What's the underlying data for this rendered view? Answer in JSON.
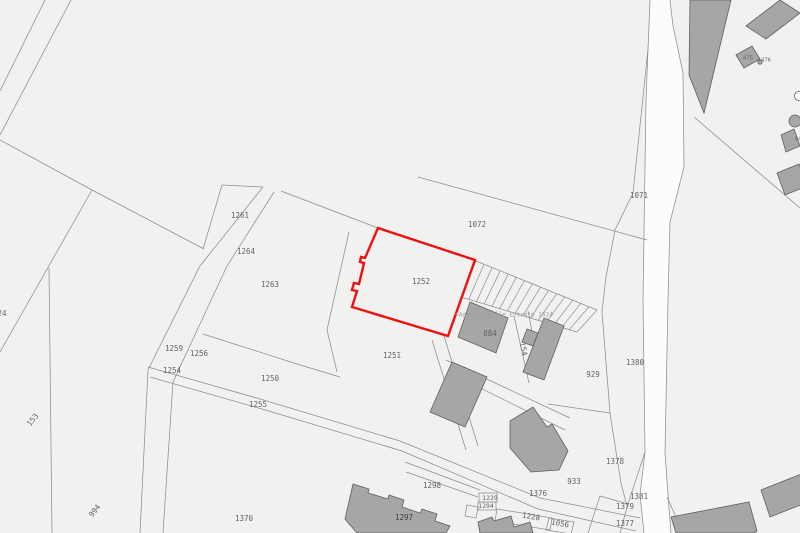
{
  "map": {
    "colors": {
      "background": "#f1f1ef",
      "parcel_line": "#8d8d8d",
      "building_fill": "#a6a6a6",
      "building_stroke": "#5f5f5f",
      "road_fill": "#fcfcfb",
      "highlight_red": "#ee1010",
      "label_gray": "#636363",
      "label_dark": "#3f3f3f",
      "watermark_gray": "#9c9c9c"
    },
    "watermark": {
      "text": "©Agenzia delle Entrate 2024",
      "x": 504,
      "y": 315,
      "size": 6
    },
    "highlighted_parcel": {
      "number": "1252",
      "path": "M378,228 L475,260 L448,336 L352,307 L357,291 L352,290 L354,283 L359,284 L364,263 L360,262 L361,257 L365,258 Z",
      "stroke_width": 2.4
    },
    "labels": [
      {
        "text": "1261",
        "x": 240,
        "y": 216
      },
      {
        "text": "1264",
        "x": 246,
        "y": 252
      },
      {
        "text": "1263",
        "x": 270,
        "y": 285
      },
      {
        "text": "1259",
        "x": 174,
        "y": 349
      },
      {
        "text": "1256",
        "x": 199,
        "y": 354
      },
      {
        "text": "1254",
        "x": 172,
        "y": 371
      },
      {
        "text": "1250",
        "x": 270,
        "y": 379
      },
      {
        "text": "1255",
        "x": 258,
        "y": 405
      },
      {
        "text": "153",
        "x": 33,
        "y": 420,
        "rot": -52
      },
      {
        "text": "994",
        "x": 95,
        "y": 511,
        "rot": -52
      },
      {
        "text": "24",
        "x": 2,
        "y": 314
      },
      {
        "text": "1370",
        "x": 244,
        "y": 519
      },
      {
        "text": "1072",
        "x": 477,
        "y": 225
      },
      {
        "text": "1071",
        "x": 639,
        "y": 196
      },
      {
        "text": "1252",
        "x": 421,
        "y": 282
      },
      {
        "text": "1251",
        "x": 392,
        "y": 356
      },
      {
        "text": "884",
        "x": 490,
        "y": 334
      },
      {
        "text": "154",
        "x": 523,
        "y": 349,
        "rot": 78
      },
      {
        "text": "929",
        "x": 593,
        "y": 375
      },
      {
        "text": "1380",
        "x": 635,
        "y": 363
      },
      {
        "text": "1378",
        "x": 615,
        "y": 462
      },
      {
        "text": "933",
        "x": 574,
        "y": 482
      },
      {
        "text": "1376",
        "x": 538,
        "y": 494
      },
      {
        "text": "1298",
        "x": 432,
        "y": 486
      },
      {
        "text": "1297",
        "x": 404,
        "y": 518,
        "dark": true
      },
      {
        "text": "1229",
        "x": 490,
        "y": 498,
        "size": 6.5
      },
      {
        "text": "1294",
        "x": 486,
        "y": 506,
        "size": 6.5
      },
      {
        "text": "1228",
        "x": 531,
        "y": 517,
        "rot": 10
      },
      {
        "text": "1056",
        "x": 560,
        "y": 524,
        "rot": 10
      },
      {
        "text": "1381",
        "x": 639,
        "y": 497
      },
      {
        "text": "1379",
        "x": 625,
        "y": 507
      },
      {
        "text": "1377",
        "x": 625,
        "y": 524
      },
      {
        "text": "475",
        "x": 748,
        "y": 58,
        "size": 5.5
      },
      {
        "text": "476",
        "x": 766,
        "y": 60,
        "size": 5.5
      },
      {
        "text": "94",
        "x": 798,
        "y": 139,
        "size": 5.5
      }
    ],
    "road_fill_polygon": [
      [
        650,
        0
      ],
      [
        646,
        100
      ],
      [
        643,
        300
      ],
      [
        645,
        452
      ],
      [
        640,
        495
      ],
      [
        644,
        533
      ],
      [
        671,
        533
      ],
      [
        668,
        495
      ],
      [
        665,
        452
      ],
      [
        668,
        300
      ],
      [
        670,
        222
      ],
      [
        684,
        167
      ],
      [
        683,
        73
      ],
      [
        673,
        26
      ],
      [
        670,
        0
      ]
    ],
    "boundary_lines": [
      [
        [
          45,
          0
        ],
        [
          0,
          91
        ]
      ],
      [
        [
          71,
          0
        ],
        [
          0,
          135
        ]
      ],
      [
        [
          0,
          140
        ],
        [
          92,
          190
        ]
      ],
      [
        [
          92,
          190
        ],
        [
          204,
          249
        ]
      ],
      [
        [
          92,
          190
        ],
        [
          0,
          352
        ]
      ],
      [
        [
          49,
          268
        ],
        [
          52,
          533
        ]
      ],
      [
        [
          263,
          187
        ],
        [
          200,
          266
        ],
        [
          148,
          370
        ],
        [
          140,
          533
        ]
      ],
      [
        [
          274,
          192
        ],
        [
          227,
          266
        ],
        [
          173,
          382
        ],
        [
          163,
          533
        ]
      ],
      [
        [
          222,
          185
        ],
        [
          203,
          249
        ]
      ],
      [
        [
          222,
          185
        ],
        [
          263,
          187
        ]
      ],
      [
        [
          281,
          191
        ],
        [
          378,
          228
        ]
      ],
      [
        [
          203,
          334
        ],
        [
          297,
          364
        ],
        [
          340,
          377
        ]
      ],
      [
        [
          418,
          177
        ],
        [
          647,
          240
        ]
      ],
      [
        [
          648,
          49
        ],
        [
          633,
          193
        ],
        [
          615,
          230
        ],
        [
          606,
          277
        ],
        [
          602,
          312
        ]
      ],
      [
        [
          602,
          312
        ],
        [
          610,
          413
        ],
        [
          621,
          483
        ],
        [
          627,
          506
        ]
      ],
      [
        [
          476,
          261
        ],
        [
          597,
          310
        ]
      ],
      [
        [
          461,
          297
        ],
        [
          577,
          332
        ]
      ],
      [
        [
          514,
          316
        ],
        [
          529,
          383
        ]
      ],
      [
        [
          528,
          311
        ],
        [
          541,
          378
        ]
      ],
      [
        [
          432,
          340
        ],
        [
          466,
          450
        ]
      ],
      [
        [
          444,
          336
        ],
        [
          478,
          446
        ]
      ],
      [
        [
          446,
          360
        ],
        [
          570,
          418
        ]
      ],
      [
        [
          448,
          372
        ],
        [
          565,
          430
        ]
      ],
      [
        [
          548,
          404
        ],
        [
          610,
          413
        ]
      ],
      [
        [
          148,
          367
        ],
        [
          260,
          399
        ],
        [
          400,
          441
        ],
        [
          540,
          498
        ],
        [
          640,
          518
        ]
      ],
      [
        [
          150,
          377
        ],
        [
          262,
          409
        ],
        [
          402,
          451
        ],
        [
          538,
          509
        ],
        [
          636,
          531
        ]
      ],
      [
        [
          405,
          462
        ],
        [
          480,
          490
        ]
      ],
      [
        [
          406,
          472
        ],
        [
          478,
          497
        ]
      ],
      [
        [
          645,
          452
        ],
        [
          628,
          504
        ],
        [
          620,
          533
        ]
      ],
      [
        [
          628,
          504
        ],
        [
          600,
          496
        ],
        [
          588,
          533
        ]
      ],
      [
        [
          694,
          117
        ],
        [
          800,
          208
        ]
      ],
      [
        [
          667,
          497
        ],
        [
          683,
          533
        ]
      ],
      [
        [
          349,
          232
        ],
        [
          327,
          330
        ],
        [
          337,
          372
        ]
      ],
      [
        [
          650,
          0
        ],
        [
          646,
          100
        ],
        [
          643,
          300
        ],
        [
          645,
          452
        ],
        [
          640,
          495
        ],
        [
          644,
          533
        ]
      ],
      [
        [
          670,
          0
        ],
        [
          673,
          26
        ],
        [
          683,
          73
        ],
        [
          684,
          167
        ],
        [
          670,
          222
        ],
        [
          668,
          300
        ],
        [
          665,
          452
        ],
        [
          668,
          495
        ],
        [
          671,
          533
        ]
      ]
    ],
    "strip_comb": {
      "rail_top": [
        [
          476,
          261
        ],
        [
          597,
          310
        ]
      ],
      "rail_bottom": [
        [
          461,
          297
        ],
        [
          577,
          332
        ]
      ],
      "count": 16
    },
    "small_parcel_outlines": [
      [
        [
          479,
          493
        ],
        [
          497,
          493
        ],
        [
          497,
          502
        ],
        [
          479,
          502
        ]
      ],
      [
        [
          478,
          502
        ],
        [
          496,
          502
        ],
        [
          496,
          510
        ],
        [
          478,
          510
        ]
      ],
      [
        [
          497,
          509
        ],
        [
          552,
          518
        ],
        [
          550,
          530
        ],
        [
          495,
          521
        ]
      ],
      [
        [
          549,
          518
        ],
        [
          574,
          522
        ],
        [
          571,
          534
        ],
        [
          546,
          530
        ]
      ],
      [
        [
          467,
          505
        ],
        [
          478,
          507
        ],
        [
          476,
          518
        ],
        [
          465,
          516
        ]
      ]
    ],
    "buildings": [
      [
        [
          690,
          0
        ],
        [
          731,
          0
        ],
        [
          704,
          113
        ],
        [
          689,
          75
        ]
      ],
      [
        [
          746,
          26
        ],
        [
          780,
          0
        ],
        [
          800,
          13
        ],
        [
          766,
          39
        ]
      ],
      [
        [
          736,
          55
        ],
        [
          752,
          46
        ],
        [
          760,
          59
        ],
        [
          744,
          68
        ]
      ],
      [
        [
          781,
          135
        ],
        [
          794,
          129
        ],
        [
          800,
          146
        ],
        [
          786,
          152
        ]
      ],
      [
        [
          777,
          173
        ],
        [
          799,
          164
        ],
        [
          807,
          186
        ],
        [
          785,
          195
        ]
      ],
      [
        [
          470,
          302
        ],
        [
          508,
          318
        ],
        [
          496,
          353
        ],
        [
          458,
          337
        ]
      ],
      [
        [
          544,
          318
        ],
        [
          564,
          326
        ],
        [
          544,
          380
        ],
        [
          523,
          372
        ]
      ],
      [
        [
          538,
          333
        ],
        [
          527,
          329
        ],
        [
          522,
          342
        ],
        [
          533,
          346
        ]
      ],
      [
        [
          452,
          362
        ],
        [
          487,
          377
        ],
        [
          465,
          427
        ],
        [
          430,
          412
        ]
      ],
      [
        [
          510,
          421
        ],
        [
          533,
          407
        ],
        [
          547,
          427
        ],
        [
          552,
          424
        ],
        [
          568,
          451
        ],
        [
          559,
          470
        ],
        [
          531,
          472
        ],
        [
          510,
          448
        ]
      ],
      [
        [
          353,
          484
        ],
        [
          369,
          489
        ],
        [
          368,
          493
        ],
        [
          388,
          499
        ],
        [
          389,
          495
        ],
        [
          404,
          500
        ],
        [
          402,
          507
        ],
        [
          420,
          513
        ],
        [
          422,
          509
        ],
        [
          437,
          514
        ],
        [
          435,
          521
        ],
        [
          450,
          526
        ],
        [
          446,
          533
        ],
        [
          357,
          533
        ],
        [
          345,
          519
        ]
      ],
      [
        [
          478,
          522
        ],
        [
          492,
          517
        ],
        [
          494,
          521
        ],
        [
          511,
          516
        ],
        [
          514,
          527
        ],
        [
          530,
          522
        ],
        [
          533,
          533
        ],
        [
          480,
          533
        ]
      ],
      [
        [
          671,
          517
        ],
        [
          749,
          502
        ],
        [
          757,
          531
        ],
        [
          754,
          533
        ],
        [
          676,
          533
        ]
      ],
      [
        [
          761,
          490
        ],
        [
          804,
          473
        ],
        [
          813,
          500
        ],
        [
          770,
          517
        ]
      ]
    ],
    "circles": [
      {
        "cx": 760,
        "cy": 62,
        "r": 2.2,
        "filled": true
      },
      {
        "cx": 799,
        "cy": 96,
        "r": 4.5,
        "filled": false
      },
      {
        "cx": 795,
        "cy": 121,
        "r": 6,
        "filled": true
      }
    ]
  }
}
